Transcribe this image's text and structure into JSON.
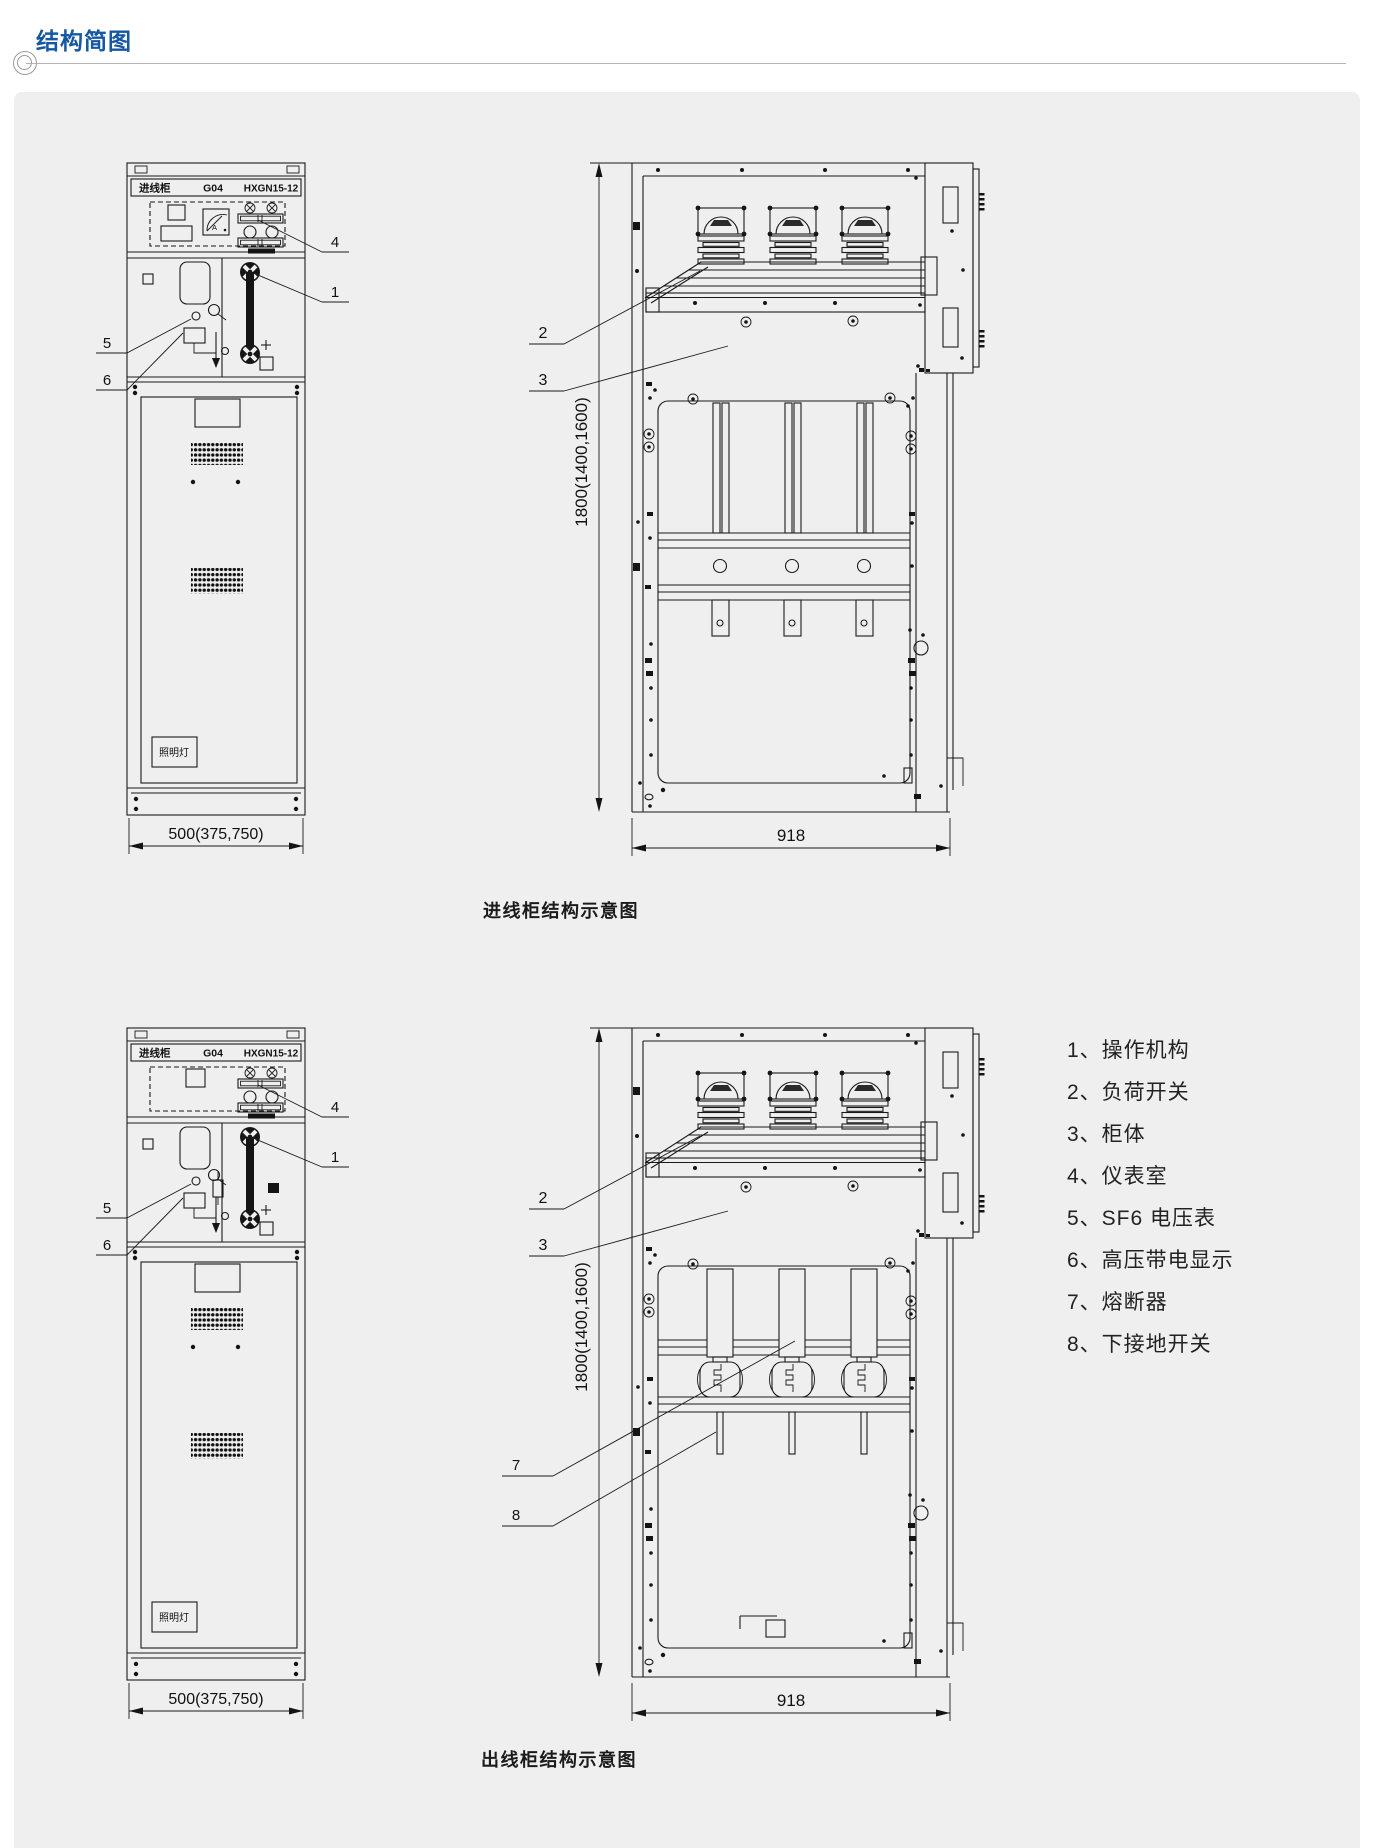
{
  "header": {
    "title": "结构简图"
  },
  "figures": [
    {
      "caption": "进线柜结构示意图",
      "nameplate": {
        "left": "进线柜",
        "mid": "G04",
        "right": "HXGN15-12"
      },
      "meter_label": "A",
      "lamp_label": "照明灯",
      "dims": {
        "front_width": "500(375,750)",
        "height": "1800(1400,1600)",
        "side_width": "918"
      },
      "callouts": {
        "c1": "1",
        "c2": "2",
        "c3": "3",
        "c4": "4",
        "c5": "5",
        "c6": "6"
      }
    },
    {
      "caption": "出线柜结构示意图",
      "nameplate": {
        "left": "进线柜",
        "mid": "G04",
        "right": "HXGN15-12"
      },
      "lamp_label": "照明灯",
      "dims": {
        "front_width": "500(375,750)",
        "height": "1800(1400,1600)",
        "side_width": "918"
      },
      "callouts": {
        "c1": "1",
        "c2": "2",
        "c3": "3",
        "c4": "4",
        "c5": "5",
        "c6": "6",
        "c7": "7",
        "c8": "8"
      }
    }
  ],
  "legend": {
    "items": [
      "1、操作机构",
      "2、负荷开关",
      "3、柜体",
      "4、仪表室",
      "5、SF6 电压表",
      "6、高压带电显示",
      "7、熔断器",
      "8、下接地开关"
    ]
  },
  "colors": {
    "accent": "#1557a2",
    "panel_bg": "#efefef",
    "line": "#1a1a1a"
  }
}
